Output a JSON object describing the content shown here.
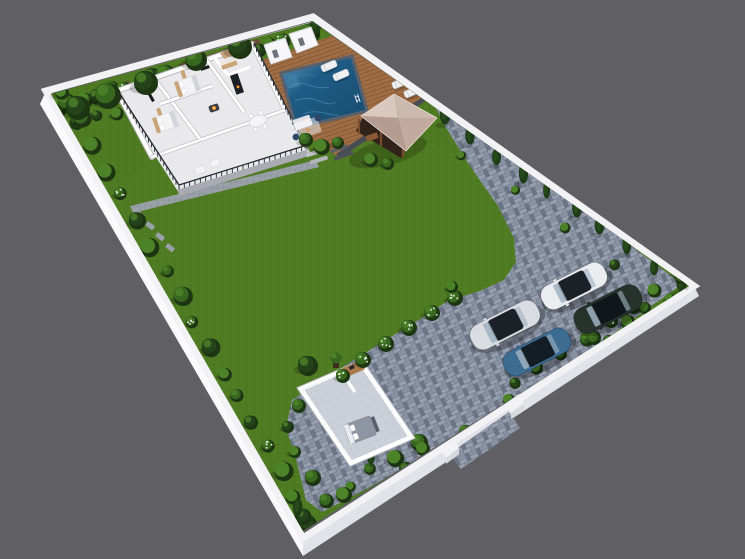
{
  "meta": {
    "title": "3D rendered residential site plan - walled plot with villa, pool, gazebo, lawn, parking and guest room",
    "view": "aerial three-quarter cutaway render",
    "visible_text": ""
  },
  "canvas": {
    "width": 745,
    "height": 559,
    "background": "#606064"
  },
  "colors": {
    "bg": "#606064",
    "wallTop": "#f2f2f5",
    "wallFaceL": "#fafafc",
    "wallFaceR": "#e2e2e9",
    "wallInnerTL": "#d6d6dc",
    "wallInnerTR": "#cbcbd3",
    "grass": "#4e7a22",
    "grassLight": "#5b8c29",
    "grassDark": "#3f6419",
    "paverBase": "#7e8798",
    "paverLight": "#99a2b2",
    "paverMid": "#8a93a4",
    "paverDark": "#6a7383",
    "paverJoint": "#5c6474",
    "gravel": "#989ea6",
    "gravelDark": "#80868e",
    "dirt": "#6d4d34",
    "deckWood": "#a06e46",
    "deckWoodDark": "#84552f",
    "deckEdge": "#474c55",
    "poolWater": "#1f5c85",
    "poolDeep": "#174b70",
    "poolRipple": "#5d96ba",
    "poolCoping": "#59616e",
    "poolStep": "#3e7ba3",
    "houseFloor": "#e9e9ec",
    "housePlinth": "#c2c2c8",
    "houseWall": "#ffffff",
    "wallShadow": "#bcbcc4",
    "tan": "#c9a478",
    "tanDark": "#a87848",
    "furnWhite": "#f4f4f6",
    "furnGray": "#d3d4d9",
    "navy": "#2e4668",
    "tvBlack": "#17191d",
    "fire": "#ff9b2e",
    "fireCore": "#ffd27a",
    "railDark": "#26292e",
    "roofA": "#d8c8be",
    "roofB": "#cbb9ae",
    "roofC": "#c2ab9e",
    "roofD": "#b49d90",
    "gazeboWood": "#7a4a2c",
    "gazeboDark": "#31231a",
    "guestFloor": "#ccd1d9",
    "bedGray": "#8f96a3",
    "bedDark": "#565d68",
    "hedgeBase": "#1d3512",
    "hedgeDark": "#24431a",
    "hedgeMid": "#386820",
    "hedgeLight": "#4d8328",
    "cypress": "#1e3c16",
    "cypressLight": "#2f5a1f",
    "flower": "#f2f2ee",
    "carSilver": "#d9dce1",
    "carBlue": "#3c6c92",
    "carWhite": "#eaecf0",
    "carDark": "#26322b",
    "carRoof": "#1c2127",
    "glass": "#9fb1c1"
  },
  "features": [
    {
      "name": "main-house",
      "description": "cutaway villa floor plan with two bedrooms, bathroom, kitchen, dining and lounge"
    },
    {
      "name": "terrace",
      "description": "railed terrace strip along the house front with seating"
    },
    {
      "name": "swimming-pool",
      "description": "rectangular pool set in a timber deck with two changing cabins, outdoor lounge and sun loungers"
    },
    {
      "name": "gazebo",
      "description": "timber gazebo with hipped roof and outdoor kitchen"
    },
    {
      "name": "lawn",
      "description": "large central lawn"
    },
    {
      "name": "driveway",
      "description": "block-paved path and parking court holding four cars"
    },
    {
      "name": "guest-room",
      "description": "detached cutaway guest suite with bed and vanity at the bottom of the plot"
    },
    {
      "name": "perimeter-wall",
      "description": "white boundary wall lined with hedges and conifers"
    },
    {
      "name": "entrance",
      "description": "driveway opening in the lower-right wall"
    }
  ],
  "counts": {
    "cars": 4,
    "sun_loungers": 4,
    "changing_cabins": 2,
    "pools": 1,
    "gazebos": 1,
    "guest_rooms": 1
  },
  "hedgeBands": [
    {
      "name": "top-left",
      "from": [
        52,
        94
      ],
      "to": [
        308,
        22
      ],
      "offset": [
        4,
        12
      ],
      "count": 20,
      "rMin": 6,
      "rMax": 11,
      "style": "bush",
      "flowerEvery": 6
    },
    {
      "name": "top-left-row2",
      "from": [
        58,
        98
      ],
      "to": [
        298,
        32
      ],
      "offset": [
        17,
        26
      ],
      "count": 12,
      "rMin": 5,
      "rMax": 8,
      "style": "bush",
      "flowerEvery": 0
    },
    {
      "name": "top-right-conifers",
      "from": [
        320,
        25
      ],
      "to": [
        686,
        282
      ],
      "offset": [
        -7,
        9
      ],
      "count": 15,
      "style": "cypress",
      "hMin": 15,
      "hMax": 23
    },
    {
      "name": "top-right-underbrush",
      "from": [
        324,
        30
      ],
      "to": [
        682,
        283
      ],
      "offset": [
        -14,
        16
      ],
      "count": 8,
      "rMin": 4,
      "rMax": 6,
      "style": "bush",
      "flowerEvery": 0
    },
    {
      "name": "bottom-left",
      "from": [
        54,
        99
      ],
      "to": [
        299,
        528
      ],
      "offset": [
        11,
        -4
      ],
      "count": 18,
      "rMin": 6,
      "rMax": 10,
      "style": "bush",
      "flowerEvery": 5
    },
    {
      "name": "bottom-right",
      "from": [
        307,
        526
      ],
      "to": [
        686,
        288
      ],
      "offset": [
        -6,
        -10
      ],
      "count": 17,
      "rMin": 5,
      "rMax": 9,
      "style": "bush",
      "skip": [
        0.34,
        0.56
      ],
      "flowerEvery": 7
    },
    {
      "name": "bottom-right-conifers",
      "from": [
        307,
        526
      ],
      "to": [
        686,
        288
      ],
      "offset": [
        -9,
        -13
      ],
      "count": 6,
      "style": "cypress",
      "hMin": 12,
      "hMax": 18,
      "skip": [
        0.28,
        0.64
      ]
    }
  ],
  "bushes": [
    [
      306,
      140,
      7,
      0
    ],
    [
      322,
      147,
      8,
      2
    ],
    [
      338,
      143,
      6,
      0
    ],
    [
      371,
      160,
      7,
      2
    ],
    [
      388,
      164,
      6,
      0
    ],
    [
      455,
      298,
      8,
      3
    ],
    [
      432,
      313,
      8,
      3
    ],
    [
      409,
      328,
      8,
      3
    ],
    [
      386,
      344,
      8,
      3
    ],
    [
      363,
      360,
      8,
      3
    ],
    [
      343,
      376,
      7,
      3
    ],
    [
      452,
      287,
      6,
      2
    ],
    [
      299,
      406,
      7,
      0
    ],
    [
      288,
      427,
      6,
      1
    ],
    [
      295,
      452,
      6,
      2
    ],
    [
      313,
      478,
      8,
      0
    ],
    [
      344,
      495,
      8,
      2
    ],
    [
      377,
      493,
      8,
      0
    ],
    [
      407,
      470,
      8,
      1
    ],
    [
      423,
      449,
      7,
      2
    ],
    [
      594,
      338,
      7,
      0
    ],
    [
      610,
      342,
      7,
      1
    ],
    [
      628,
      322,
      7,
      2
    ],
    [
      645,
      308,
      6,
      0
    ],
    [
      466,
      432,
      7,
      0
    ],
    [
      509,
      400,
      6,
      2
    ]
  ],
  "trees": [
    [
      78,
      108,
      12,
      1
    ],
    [
      108,
      96,
      13,
      0
    ],
    [
      146,
      83,
      12,
      1
    ],
    [
      196,
      60,
      11,
      0
    ],
    [
      240,
      47,
      12,
      1
    ],
    [
      308,
      366,
      10,
      1
    ],
    [
      622,
      310,
      8,
      1
    ]
  ],
  "loungers": [
    [
      329,
      66
    ],
    [
      341,
      75
    ],
    [
      400,
      83
    ],
    [
      412,
      92
    ]
  ],
  "railings": [
    {
      "from": [
        179,
        189
      ],
      "to": [
        307,
        149
      ]
    },
    {
      "from": [
        118,
        95
      ],
      "to": [
        179,
        189
      ]
    },
    {
      "from": [
        254,
        47
      ],
      "to": [
        305,
        148
      ]
    }
  ],
  "cars": [
    {
      "name": "silver-sedan",
      "x": 505,
      "y": 325,
      "rot": -27,
      "len": 74,
      "wid": 27,
      "body": "#d9dce1",
      "roof": "#1c2127"
    },
    {
      "name": "blue-sedan",
      "x": 537,
      "y": 352,
      "rot": -27,
      "len": 72,
      "wid": 26,
      "body": "#3c6c92",
      "roof": "#141c24"
    },
    {
      "name": "white-sedan",
      "x": 574,
      "y": 286,
      "rot": -27,
      "len": 70,
      "wid": 26,
      "body": "#eaecf0",
      "roof": "#1c2127"
    },
    {
      "name": "dark-green-suv",
      "x": 608,
      "y": 309,
      "rot": -27,
      "len": 72,
      "wid": 27,
      "body": "#26322b",
      "roof": "#10161a"
    }
  ]
}
